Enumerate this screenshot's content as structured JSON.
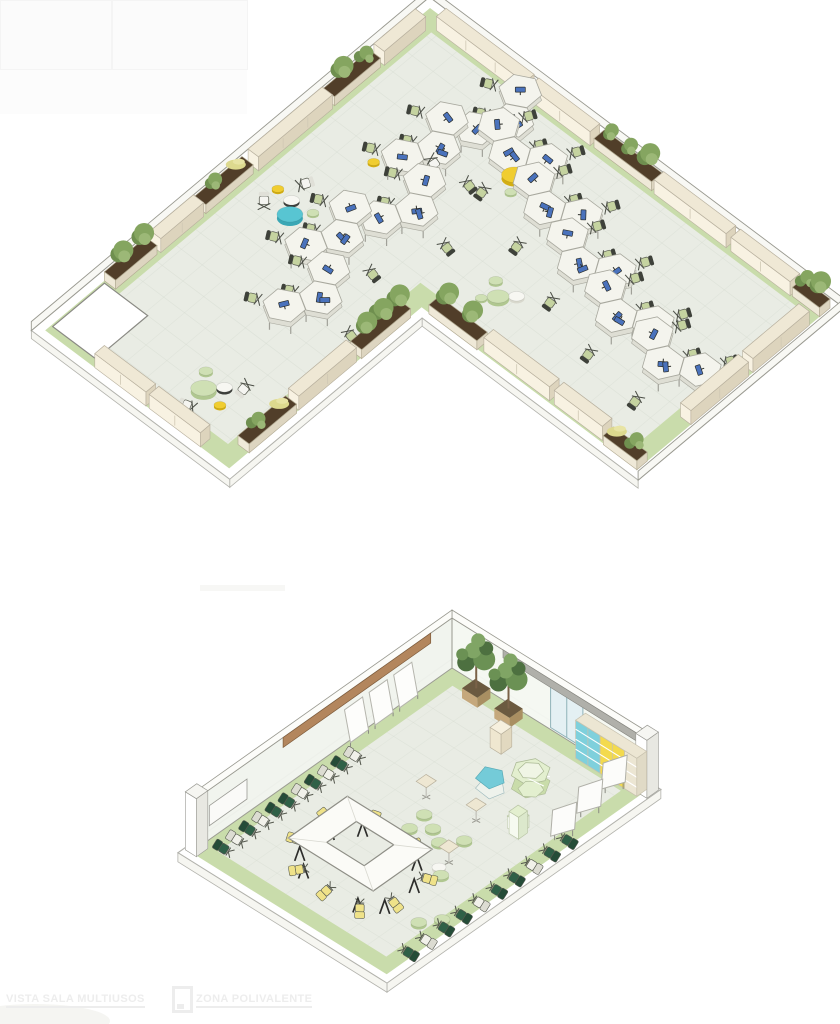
{
  "page": {
    "width": 840,
    "height": 1024,
    "background": "#ffffff"
  },
  "captions": {
    "left": "VISTA SALA MULTIUSOS",
    "right": "ZONA POLIVALENTE"
  },
  "palette": {
    "floor": "#e9ece4",
    "band": "#c9dcab",
    "slab": "#ffffff",
    "rimfill": "#f6f6f1",
    "wall": "#f8f8f4",
    "wall_line": "#98988f",
    "edge": "#b2b2ac",
    "tile": "#d4dacf",
    "credenza_top": "#efe8d5",
    "credenza_front": "#f8f2e2",
    "credenza_side": "#ddd4bd",
    "credenza_line": "#b8b09e",
    "soil": "#513e29",
    "pbox_front": "#efe9d8",
    "pbox_side": "#ddd5c0",
    "pbox_line": "#b0a890",
    "plant1": "#6f8f4f",
    "plant2": "#85a560",
    "plant3": "#9cb877",
    "grass": "#ddd98e",
    "desk_top": "#f4f4ed",
    "desk_side": "#deded4",
    "desk_line": "#a8a89e",
    "monitor": "#4a72bc",
    "dark": "#2c2e2a",
    "seat": "#c5d3a0",
    "seat_back": "#3e413a",
    "p_teal": "#58c5d2",
    "p_teal_s": "#3aa7b5",
    "p_yellow": "#f0cd30",
    "p_yellow_s": "#d3ae13",
    "p_green": "#cfe0b4",
    "p_green_s": "#b0c790",
    "p_white": "#f7f7f2",
    "p_white_s": "#d8d8cd",
    "p_wtable_s": "#3d3f3b",
    "wood": "#b3865d",
    "wood_line": "#7d5a3a",
    "glass": "#e4f0f3",
    "glass_line": "#8fb2b8",
    "rail": "#b0b0aa",
    "shelf_cyan": "#7fd0dc",
    "shelf_yellow": "#f3da4e",
    "shelf_beige": "#ece6d3",
    "shelf_line": "#c7c1ae",
    "table_top": "#fbfbf7",
    "leg": "#2d2d2b",
    "ychair": "#efe289",
    "gchair": "#2f6047",
    "wchair": "#f1f1ea",
    "disp1": "#e3efcf",
    "disp2": "#c9dcaa",
    "disp3": "#f0f5e5",
    "disp_cyan": "#74cbd8",
    "caption": "#ededed"
  },
  "scene_top": {
    "name": "open-office-floor",
    "origin": [
      430,
      8
    ],
    "a": [
      0.8,
      0.6
    ],
    "b": [
      -0.74,
      0.62
    ],
    "wallH": 9,
    "outline": [
      [
        0,
        0
      ],
      [
        500,
        0
      ],
      [
        500,
        260
      ],
      [
        230,
        260
      ],
      [
        230,
        520
      ],
      [
        0,
        520
      ]
    ],
    "outer": [
      [
        -9,
        -9
      ],
      [
        509,
        -9
      ],
      [
        509,
        269
      ],
      [
        239,
        269
      ],
      [
        239,
        529
      ],
      [
        -9,
        529
      ]
    ],
    "inner": [
      [
        20,
        20
      ],
      [
        480,
        20
      ],
      [
        480,
        240
      ],
      [
        210,
        240
      ],
      [
        210,
        500
      ],
      [
        20,
        500
      ]
    ],
    "door": {
      "u": 2,
      "v": 442,
      "du": 54,
      "dv": 70
    },
    "credenzas": [
      [
        2,
        22,
        56,
        "B"
      ],
      [
        2,
        148,
        100,
        "B"
      ],
      [
        2,
        322,
        58,
        "B"
      ],
      [
        22,
        2,
        110,
        "A"
      ],
      [
        138,
        2,
        76,
        "A"
      ],
      [
        294,
        2,
        90,
        "A"
      ],
      [
        390,
        2,
        74,
        "A"
      ],
      [
        487,
        28,
        76,
        "B"
      ],
      [
        487,
        110,
        78,
        "B"
      ],
      [
        306,
        245,
        82,
        "A"
      ],
      [
        394,
        245,
        60,
        "A"
      ],
      [
        217,
        348,
        78,
        "B"
      ],
      [
        62,
        507,
        64,
        "A"
      ],
      [
        130,
        507,
        64,
        "A"
      ]
    ],
    "planters": [
      [
        0,
        82,
        62,
        "B",
        "tall"
      ],
      [
        0,
        254,
        64,
        "B",
        "grass"
      ],
      [
        0,
        384,
        56,
        "B",
        "bush"
      ],
      [
        218,
        0,
        72,
        "A",
        "tall"
      ],
      [
        466,
        0,
        34,
        "A",
        "tall"
      ],
      [
        240,
        247,
        60,
        "A",
        "bush"
      ],
      [
        458,
        247,
        42,
        "A",
        "grass"
      ],
      [
        217,
        276,
        66,
        "B",
        "bush"
      ],
      [
        217,
        430,
        64,
        "B",
        "grass"
      ]
    ],
    "desk_pods": [
      [
        145,
        55,
        "B"
      ],
      [
        118,
        125,
        "B"
      ],
      [
        152,
        192,
        "B"
      ],
      [
        124,
        262,
        "B"
      ],
      [
        158,
        328,
        "B"
      ],
      [
        178,
        76,
        "A"
      ],
      [
        244,
        100,
        "A"
      ],
      [
        310,
        126,
        "A"
      ],
      [
        376,
        146,
        "A"
      ],
      [
        444,
        156,
        "A"
      ]
    ],
    "poufs": [
      [
        70,
        265,
        13,
        "teal"
      ],
      [
        60,
        252,
        8,
        "wtable"
      ],
      [
        42,
        251,
        6,
        "yellow"
      ],
      [
        84,
        249,
        6,
        "green"
      ],
      [
        187,
        88,
        13,
        "yellow"
      ],
      [
        196,
        72,
        7,
        "green"
      ],
      [
        208,
        90,
        8,
        "white"
      ],
      [
        198,
        105,
        6,
        "green"
      ],
      [
        84,
        167,
        6,
        "yellow"
      ],
      [
        272,
        202,
        11,
        "green"
      ],
      [
        258,
        190,
        7,
        "green"
      ],
      [
        284,
        190,
        8,
        "white"
      ],
      [
        262,
        214,
        6,
        "green"
      ],
      [
        150,
        468,
        13,
        "green"
      ],
      [
        138,
        452,
        7,
        "green"
      ],
      [
        163,
        454,
        8,
        "wtable"
      ],
      [
        174,
        472,
        6,
        "yellow"
      ]
    ],
    "white_chairs": [
      [
        46,
        274
      ],
      [
        54,
        233
      ],
      [
        120,
        128
      ],
      [
        176,
        438
      ],
      [
        157,
        492
      ]
    ]
  },
  "scene_room": {
    "name": "sala-multiusos",
    "origin": [
      452,
      668
    ],
    "a": [
      0.85,
      0.53
    ],
    "b": [
      -0.82,
      0.58
    ],
    "wallH": 50,
    "outline": [
      [
        0,
        0
      ],
      [
        230,
        0
      ],
      [
        230,
        318
      ],
      [
        0,
        318
      ]
    ],
    "outer": [
      [
        -8,
        -8
      ],
      [
        238,
        -8
      ],
      [
        238,
        326
      ],
      [
        -8,
        326
      ]
    ],
    "inner": [
      [
        16,
        16
      ],
      [
        214,
        16
      ],
      [
        214,
        302
      ],
      [
        16,
        302
      ]
    ],
    "wood_strip": {
      "v0": 26,
      "v1": 206
    },
    "glass_door": {
      "u0": 116,
      "u1": 154
    },
    "rail": {
      "u0": 60,
      "u1": 232
    },
    "shelf": {
      "u0": 157,
      "u1": 229,
      "bays": [
        "cyan",
        "cyan",
        "yellow",
        "yellow",
        "beige"
      ]
    },
    "trees": [
      [
        42,
        8
      ],
      [
        80,
        8
      ]
    ],
    "pedestal": [
      94,
      38
    ],
    "whiteboards": [
      58,
      88,
      118
    ],
    "chair_row_wall": {
      "u": 20,
      "v0": 136,
      "step": 16,
      "n": 11,
      "colors": [
        "w",
        "g",
        "w",
        "g",
        "w",
        "g",
        "g",
        "w",
        "g",
        "w",
        "g"
      ]
    },
    "chair_row_front": {
      "u": 221,
      "v0": 92,
      "step": 21.5,
      "n": 10,
      "colors": [
        "g",
        "g",
        "w",
        "g",
        "g",
        "w",
        "g",
        "g",
        "w",
        "g"
      ]
    },
    "ring_table": {
      "center": [
        112,
        228
      ],
      "outer": [
        100,
        72
      ],
      "inner": [
        44,
        36
      ]
    },
    "yellow_chairs": [
      [
        88,
        188
      ],
      [
        130,
        188
      ],
      [
        168,
        208
      ],
      [
        168,
        247
      ],
      [
        152,
        270
      ],
      [
        118,
        273
      ],
      [
        84,
        270
      ],
      [
        57,
        210
      ],
      [
        57,
        245
      ]
    ],
    "green_poufs": [
      [
        112,
        150
      ],
      [
        130,
        158
      ],
      [
        115,
        171
      ],
      [
        146,
        167
      ],
      [
        160,
        151
      ],
      [
        176,
        196
      ],
      [
        204,
        252
      ],
      [
        216,
        236
      ]
    ],
    "white_poufs": [
      [
        168,
        190
      ]
    ],
    "side_tables": [
      [
        98,
        133
      ],
      [
        150,
        126
      ],
      [
        170,
        180
      ]
    ],
    "partitions": [
      [
        212,
        22
      ],
      [
        218,
        58
      ],
      [
        222,
        94
      ]
    ],
    "columns": [
      [
        224,
        -6
      ],
      [
        -6,
        305
      ]
    ]
  }
}
